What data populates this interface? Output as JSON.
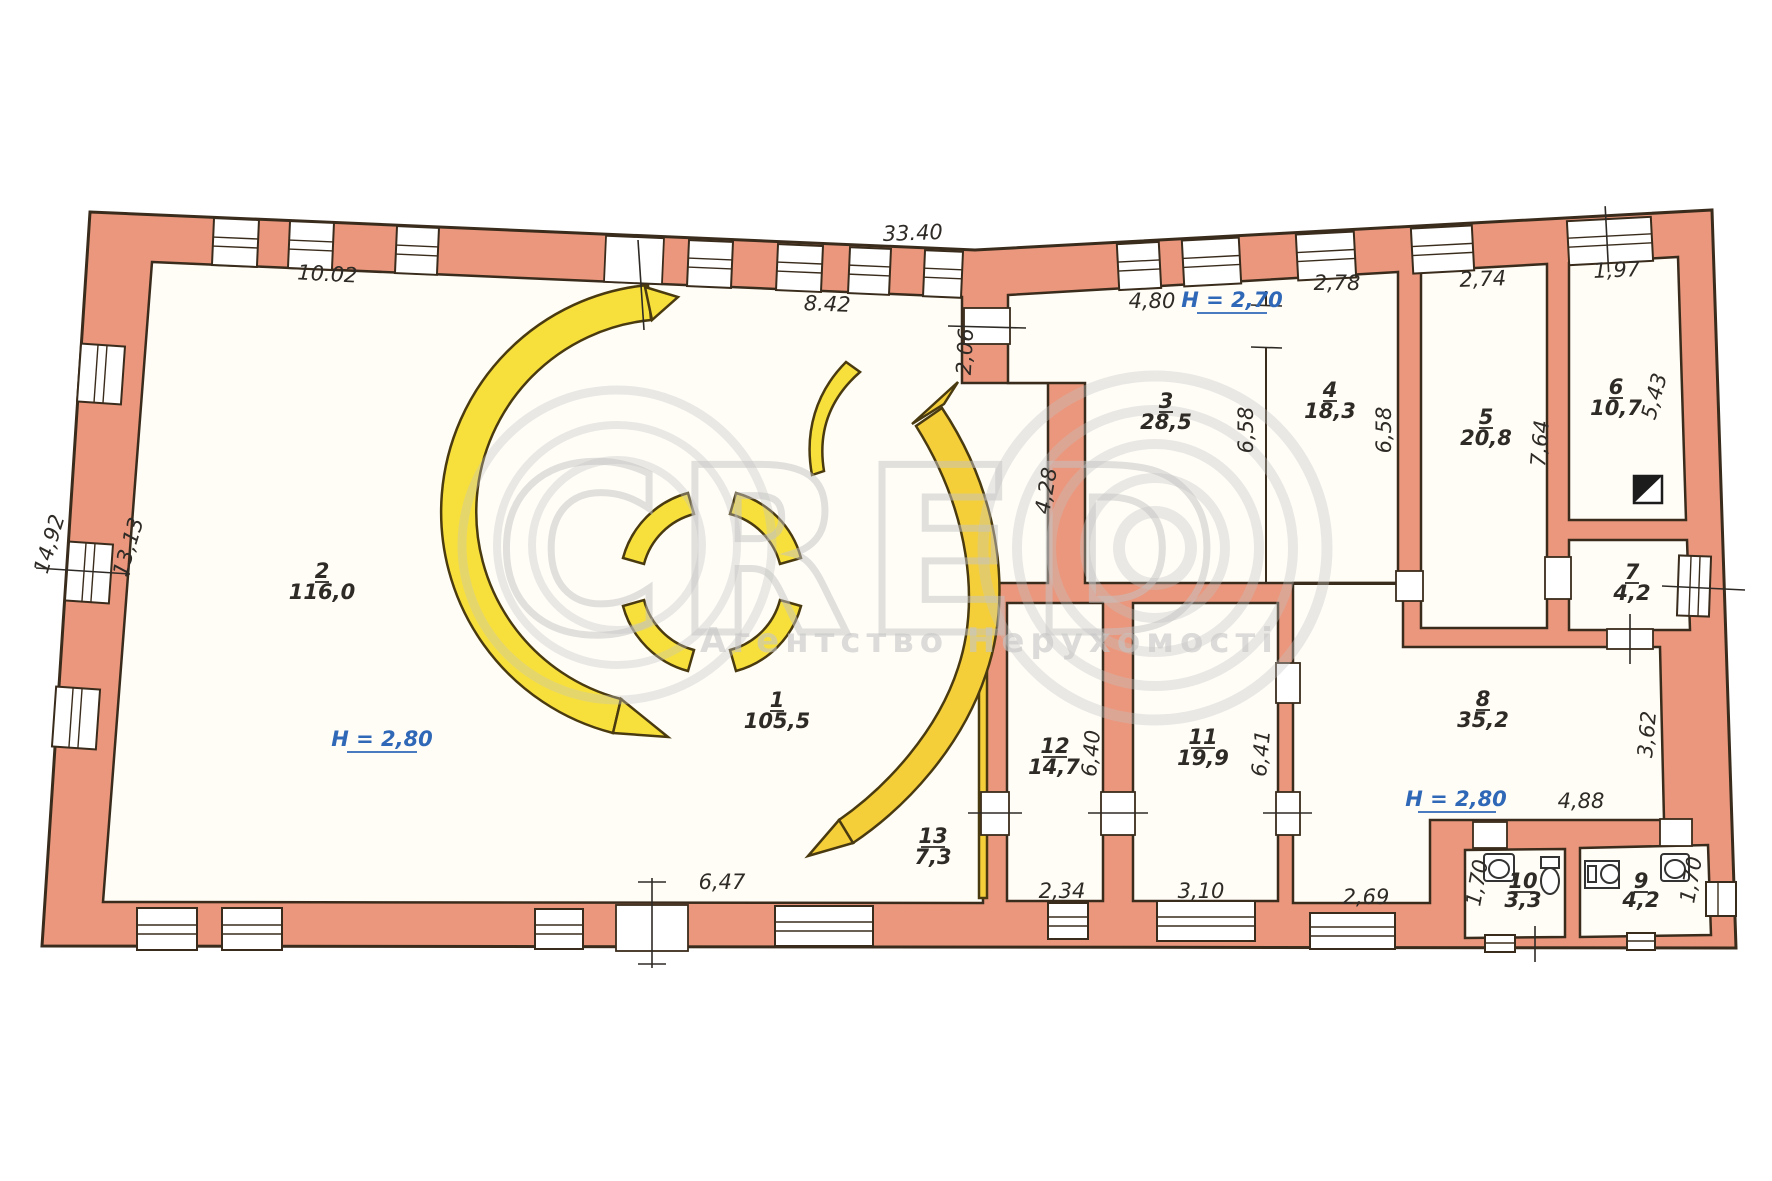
{
  "watermark": {
    "brand": "CRED",
    "subtitle": "Агентство Нерухомості"
  },
  "heights": {
    "room2": "H = 2,80",
    "room3": "H = 2,70",
    "room8": "H = 2,80"
  },
  "rooms": [
    {
      "number": "1",
      "area": "105,5"
    },
    {
      "number": "2",
      "area": "116,0"
    },
    {
      "number": "3",
      "area": "28,5"
    },
    {
      "number": "4",
      "area": "18,3"
    },
    {
      "number": "5",
      "area": "20,8"
    },
    {
      "number": "6",
      "area": "10,7"
    },
    {
      "number": "7",
      "area": "4,2"
    },
    {
      "number": "8",
      "area": "35,2"
    },
    {
      "number": "9",
      "area": "4,2"
    },
    {
      "number": "10",
      "area": "3,3"
    },
    {
      "number": "11",
      "area": "19,9"
    },
    {
      "number": "12",
      "area": "14,7"
    },
    {
      "number": "13",
      "area": "7,3"
    }
  ],
  "dims": {
    "top_total": "33.40",
    "room2_top": "10.02",
    "room1_top": "8.42",
    "wall_206": "2,06",
    "wall_428": "4,28",
    "room3_top": "4,80",
    "room4_top": "2,78",
    "room5_top": "2,74",
    "room6_top": "1,97",
    "room3_h": "6,58",
    "room4_h": "6,58",
    "room5_h": "7,64",
    "room6_h": "5,43",
    "left_out": "14,92",
    "left_in": "13,13",
    "room1_bottom": "6,47",
    "room12_w": "2,34",
    "room11_w": "3,10",
    "hall_w": "2,69",
    "room12_h": "6,40",
    "room11_h": "6,41",
    "room8_h": "3,62",
    "room8_w": "4,88",
    "wc10_h": "1,70",
    "wc9_h": "1,70"
  },
  "colors": {
    "wall": "#ea977d",
    "outline": "#3a2c1c",
    "partition_yellow": "#f8e03c",
    "room_fill": "#fffdf6",
    "height_text": "#3068b8",
    "dim_text": "#2e2a26",
    "watermark": "#c4c4c4"
  }
}
